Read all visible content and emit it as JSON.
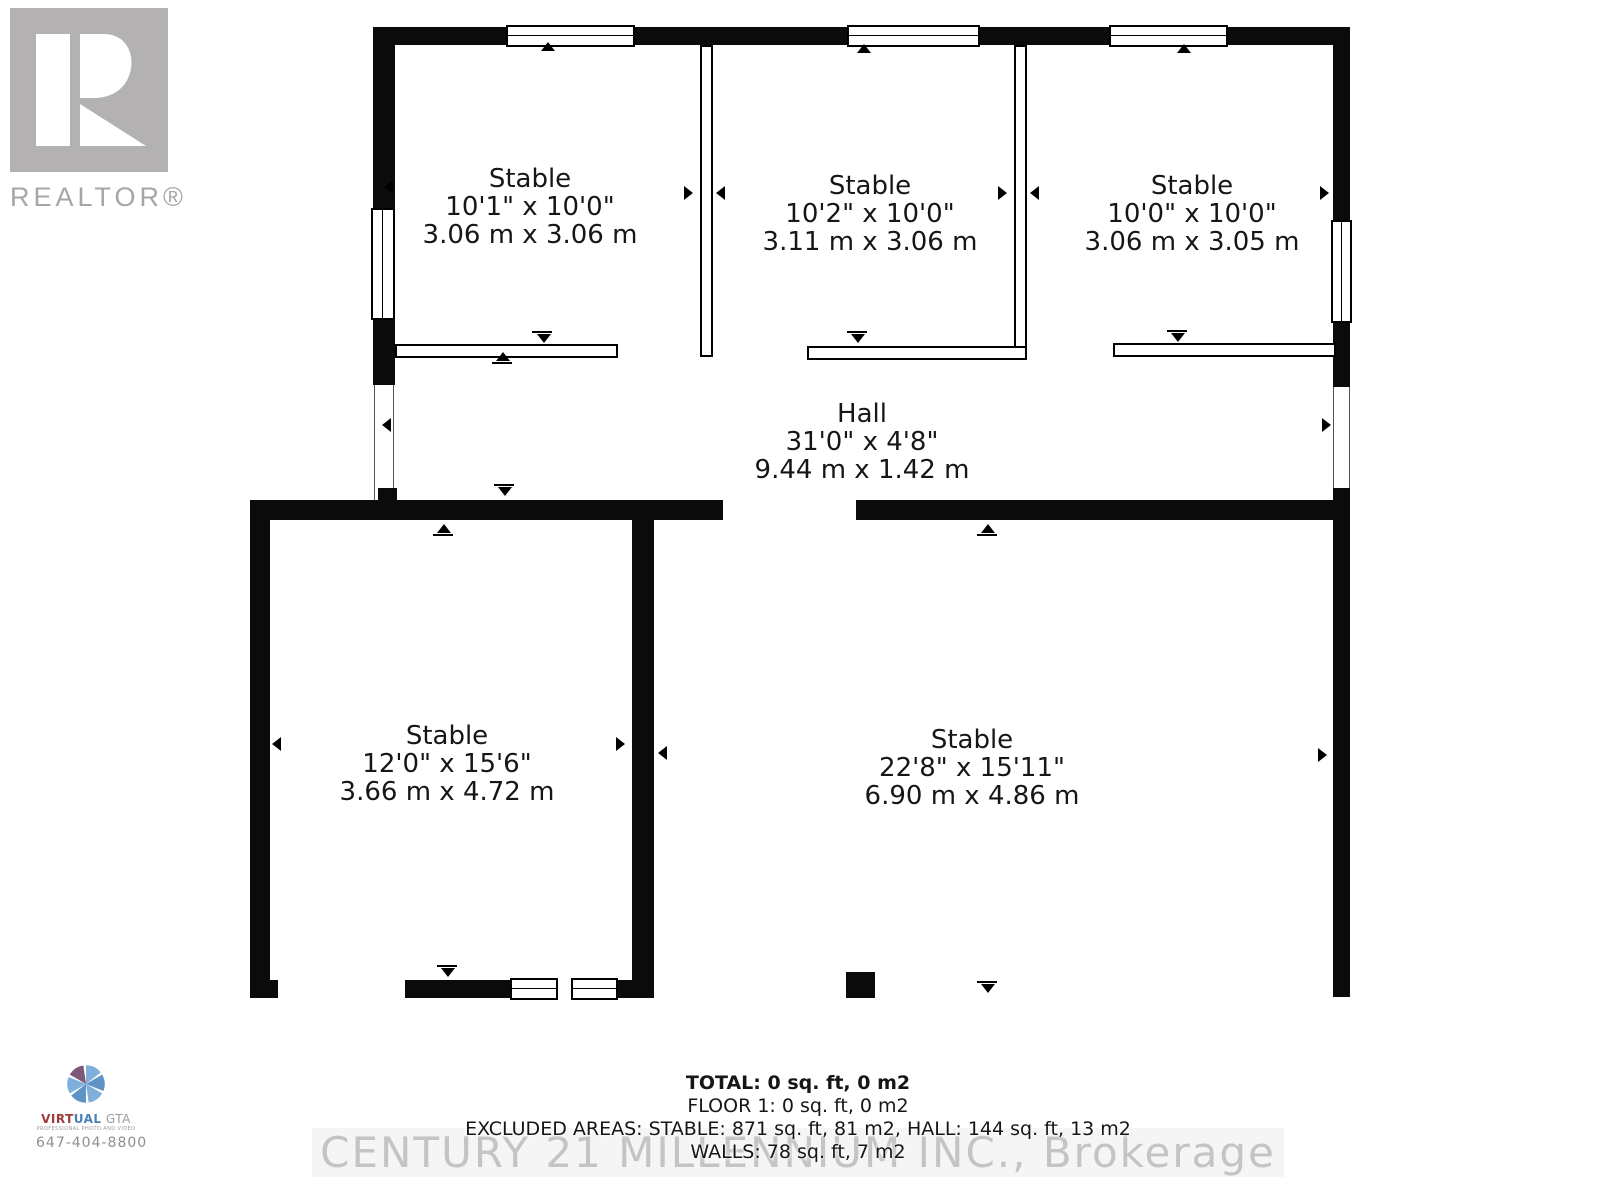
{
  "branding": {
    "realtor_logo_label": "REALTOR®",
    "watermark": "CENTURY 21 MILLENNIUM INC., Brokerage",
    "photo_credit": {
      "name_part1": "VIRT",
      "name_part2": "UAL",
      "name_part3": " GTA",
      "tagline": "PROFESSIONAL PHOTO AND VIDEO",
      "phone": "647-404-8800"
    }
  },
  "rooms": [
    {
      "id": "stable-1",
      "name": "Stable",
      "imperial": "10'1\" x 10'0\"",
      "metric": "3.06 m x 3.06 m"
    },
    {
      "id": "stable-2",
      "name": "Stable",
      "imperial": "10'2\" x 10'0\"",
      "metric": "3.11 m x 3.06 m"
    },
    {
      "id": "stable-3",
      "name": "Stable",
      "imperial": "10'0\" x 10'0\"",
      "metric": "3.06 m x 3.05 m"
    },
    {
      "id": "hall",
      "name": "Hall",
      "imperial": "31'0\" x 4'8\"",
      "metric": "9.44 m x 1.42 m"
    },
    {
      "id": "stable-4",
      "name": "Stable",
      "imperial": "12'0\" x 15'6\"",
      "metric": "3.66 m x 4.72 m"
    },
    {
      "id": "stable-5",
      "name": "Stable",
      "imperial": "22'8\" x 15'11\"",
      "metric": "6.90 m x 4.86 m"
    }
  ],
  "summary": {
    "total": "TOTAL: 0 sq. ft, 0 m2",
    "floor": "FLOOR 1: 0 sq. ft, 0 m2",
    "excluded": "EXCLUDED AREAS: STABLE: 871 sq. ft, 81 m2, HALL: 144 sq. ft, 13 m2",
    "walls": "WALLS: 78 sq. ft, 7 m2"
  },
  "colors": {
    "wall": "#0b0b0b",
    "logo_gray": "#b3b1b1",
    "realtor_text": "#a7a5a5",
    "watermark_gray": "#c4c4c4",
    "aperture_blue": "#5e93c5",
    "aperture_blue_light": "#7fb0dc",
    "aperture_purple": "#7d5878",
    "brand_red": "#a03c3c",
    "brand_blue": "#4b80b4",
    "brand_gray": "#9b9b9b"
  }
}
